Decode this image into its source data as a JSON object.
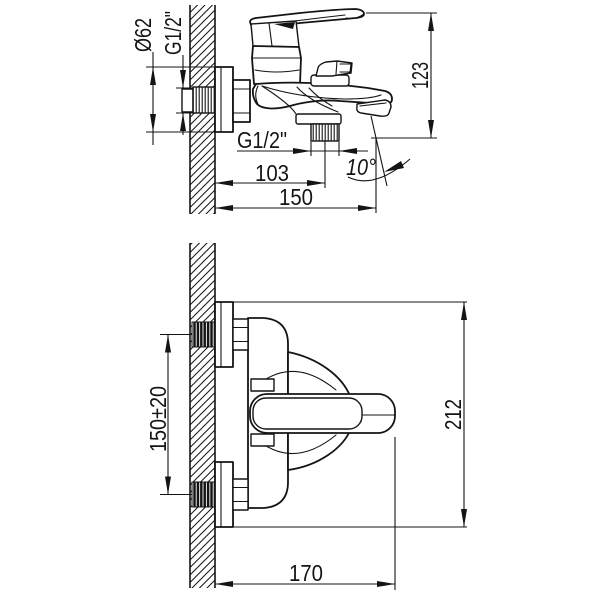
{
  "drawing": {
    "background": "#ffffff",
    "line_color": "#141414",
    "views": {
      "side": {
        "dims": {
          "flange_diameter": "Ø62",
          "inlet_thread": "G1/2\"",
          "overall_height": "123",
          "outlet_thread": "G1/2\"",
          "outlet_offset": "103",
          "spout_reach": "150",
          "spout_angle": "10°"
        }
      },
      "plan": {
        "dims": {
          "inlet_spacing": "150±20",
          "overall_length": "212",
          "handle_reach": "170"
        }
      }
    }
  }
}
